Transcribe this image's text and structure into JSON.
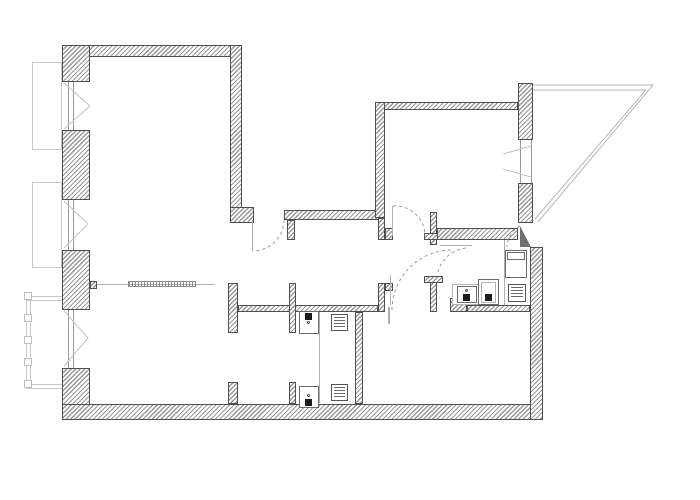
{
  "canvas": {
    "width": 700,
    "height": 500,
    "background": "#ffffff"
  },
  "drawing": {
    "type": "architectural-floor-plan",
    "colors": {
      "wall_outline": "#4f4f4f",
      "wall_hatch": "#989898",
      "dashed_arc": "#999999",
      "thin_line": "#b0b0b0",
      "fixture_line": "#6a6a6a",
      "dark_fill": "#1b1b1b",
      "exterior_line": "#c9c9c9",
      "symbol_line": "#c4c4c4",
      "balcony_line": "#b8b8b8",
      "door_leaf_fill": "#6f6f6f"
    }
  },
  "walls": [
    {
      "name": "top-wall",
      "x": 62,
      "y": 45,
      "w": 178,
      "h": 12
    },
    {
      "name": "left-pier-1",
      "x": 62,
      "y": 45,
      "w": 28,
      "h": 37
    },
    {
      "name": "left-pier-2",
      "x": 62,
      "y": 130,
      "w": 28,
      "h": 70
    },
    {
      "name": "left-pier-3",
      "x": 62,
      "y": 250,
      "w": 28,
      "h": 60
    },
    {
      "name": "left-pier-3-tab",
      "x": 90,
      "y": 281,
      "w": 7,
      "h": 8
    },
    {
      "name": "bottom-left-corner",
      "x": 62,
      "y": 368,
      "w": 28,
      "h": 52
    },
    {
      "name": "bottom-wall",
      "x": 62,
      "y": 404,
      "w": 481,
      "h": 16
    },
    {
      "name": "room1-right-wall",
      "x": 230,
      "y": 45,
      "w": 12,
      "h": 164
    },
    {
      "name": "room1-right-foot",
      "x": 230,
      "y": 207,
      "w": 24,
      "h": 16
    },
    {
      "name": "hall-top-wall",
      "x": 284,
      "y": 210,
      "w": 101,
      "h": 10
    },
    {
      "name": "hall-top-stub",
      "x": 287,
      "y": 220,
      "w": 8,
      "h": 20
    },
    {
      "name": "bedroom-top-wall",
      "x": 375,
      "y": 102,
      "w": 143,
      "h": 8
    },
    {
      "name": "bedroom-left-wall",
      "x": 375,
      "y": 102,
      "w": 10,
      "h": 116
    },
    {
      "name": "bedroom-left-wall-lower",
      "x": 378,
      "y": 218,
      "w": 7,
      "h": 22
    },
    {
      "name": "bedroom-door-jamb",
      "x": 385,
      "y": 228,
      "w": 8,
      "h": 12
    },
    {
      "name": "vestibule-stub",
      "x": 430,
      "y": 212,
      "w": 7,
      "h": 33
    },
    {
      "name": "vestibule-tab",
      "x": 424,
      "y": 233,
      "w": 34,
      "h": 7
    },
    {
      "name": "bedroom-bottom-wall",
      "x": 437,
      "y": 228,
      "w": 81,
      "h": 12
    },
    {
      "name": "right-pier-1",
      "x": 518,
      "y": 83,
      "w": 15,
      "h": 57
    },
    {
      "name": "right-pier-2",
      "x": 518,
      "y": 183,
      "w": 15,
      "h": 40
    },
    {
      "name": "right-wall",
      "x": 530,
      "y": 247,
      "w": 13,
      "h": 173
    },
    {
      "name": "kitchen-left-wall",
      "x": 430,
      "y": 276,
      "w": 7,
      "h": 36
    },
    {
      "name": "kitchen-left-tab",
      "x": 424,
      "y": 276,
      "w": 19,
      "h": 7
    },
    {
      "name": "hall-bottom-wall",
      "x": 238,
      "y": 305,
      "w": 140,
      "h": 7
    },
    {
      "name": "mid-stub",
      "x": 378,
      "y": 283,
      "w": 7,
      "h": 29
    },
    {
      "name": "mid-stub-foot",
      "x": 385,
      "y": 283,
      "w": 8,
      "h": 8
    },
    {
      "name": "closet-wall-upper",
      "x": 228,
      "y": 283,
      "w": 10,
      "h": 50
    },
    {
      "name": "bath-wall-upper",
      "x": 289,
      "y": 283,
      "w": 7,
      "h": 50
    },
    {
      "name": "closet-wall-lower",
      "x": 228,
      "y": 382,
      "w": 10,
      "h": 22
    },
    {
      "name": "bath-wall-lower",
      "x": 289,
      "y": 382,
      "w": 7,
      "h": 22
    },
    {
      "name": "bath-right-wall",
      "x": 355,
      "y": 312,
      "w": 8,
      "h": 92
    },
    {
      "name": "kitchen-corner",
      "x": 450,
      "y": 298,
      "w": 17,
      "h": 14
    },
    {
      "name": "kitchen-bottom-wall",
      "x": 467,
      "y": 305,
      "w": 63,
      "h": 7
    }
  ],
  "windows": [
    {
      "name": "window-left-1",
      "x": 68,
      "y": 82,
      "w": 6,
      "h": 48
    },
    {
      "name": "window-left-2",
      "x": 68,
      "y": 200,
      "w": 6,
      "h": 50
    },
    {
      "name": "window-left-3",
      "x": 68,
      "y": 310,
      "w": 6,
      "h": 58
    },
    {
      "name": "window-bedroom",
      "x": 520,
      "y": 140,
      "w": 12,
      "h": 43
    }
  ],
  "window_symbols": [
    {
      "name": "casement-swing-left-1",
      "points": "64,83 90,106 64,129"
    },
    {
      "name": "casement-swing-left-2",
      "points": "64,201 88,224 64,248"
    },
    {
      "name": "casement-swing-left-3",
      "points": "64,311 88,338 64,366"
    },
    {
      "name": "casement-swing-bedroom-top",
      "points": "531,146 503,154"
    },
    {
      "name": "casement-swing-bedroom-bottom",
      "points": "531,177 503,169"
    }
  ],
  "door_arcs": [
    {
      "name": "living-door-arc",
      "d": "M 284 220 A 31 31 0 0 1 253 251"
    },
    {
      "name": "bedroom-door-arc",
      "d": "M 393 206 A 30 30 0 0 1 425 236"
    },
    {
      "name": "room2-door-arc",
      "d": "M 392 310 A 60 60 0 0 1 452 250"
    },
    {
      "name": "kitchen-door-arc",
      "d": "M 438 272 A 32 32 0 0 1 468 248"
    },
    {
      "name": "entrance-door-arc",
      "d": "M 520 226 A 24 24 0 0 0 507 247"
    }
  ],
  "door_leaves": [
    {
      "name": "living-door-leaf",
      "x": 252,
      "y": 220,
      "w": 1,
      "h": 31
    },
    {
      "name": "bedroom-door-leaf",
      "x": 392,
      "y": 206,
      "w": 1,
      "h": 30
    },
    {
      "name": "room2-door-leaf",
      "x": 388,
      "y": 307,
      "w": 2,
      "h": 17
    }
  ],
  "entrance_door": {
    "name": "entrance-door-leaf",
    "triangle_points": "520,226 531,247 520,247"
  },
  "balcony": {
    "name": "triangular-balcony",
    "outer_points": "533,85 653,85 538,222",
    "inner_points": "533,90 646,90 535,219"
  },
  "exterior_left": {
    "boxes": [
      {
        "name": "ext-window-box-1",
        "x": 32,
        "y": 62,
        "w": 30,
        "h": 88
      },
      {
        "name": "ext-window-box-2",
        "x": 32,
        "y": 182,
        "w": 30,
        "h": 86
      }
    ],
    "bay_lines": [
      {
        "x": 26,
        "y": 296,
        "w": 1,
        "h": 92
      },
      {
        "x": 30,
        "y": 296,
        "w": 1,
        "h": 92
      },
      {
        "x": 26,
        "y": 296,
        "w": 36,
        "h": 1
      },
      {
        "x": 26,
        "y": 300,
        "w": 36,
        "h": 1
      },
      {
        "x": 26,
        "y": 384,
        "w": 36,
        "h": 1
      },
      {
        "x": 26,
        "y": 388,
        "w": 36,
        "h": 1
      }
    ],
    "bay_squares": [
      {
        "x": 24,
        "y": 292,
        "w": 8,
        "h": 8
      },
      {
        "x": 24,
        "y": 314,
        "w": 8,
        "h": 8
      },
      {
        "x": 24,
        "y": 336,
        "w": 8,
        "h": 8
      },
      {
        "x": 24,
        "y": 358,
        "w": 8,
        "h": 8
      },
      {
        "x": 24,
        "y": 380,
        "w": 8,
        "h": 8
      }
    ]
  },
  "fixtures": {
    "rects": [
      {
        "name": "kitchen-tall-cabinet",
        "x": 505,
        "y": 250,
        "w": 22,
        "h": 28,
        "light": false
      },
      {
        "name": "kitchen-cabinet-shelf",
        "x": 507,
        "y": 252,
        "w": 18,
        "h": 8,
        "light": false
      },
      {
        "name": "kitchen-sink-counter",
        "x": 452,
        "y": 284,
        "w": 29,
        "h": 21,
        "light": true
      },
      {
        "name": "kitchen-sink",
        "x": 457,
        "y": 286,
        "w": 20,
        "h": 17,
        "light": false
      },
      {
        "name": "kitchen-fixture",
        "x": 478,
        "y": 279,
        "w": 21,
        "h": 26,
        "light": false
      },
      {
        "name": "kitchen-fixture-inner",
        "x": 481,
        "y": 282,
        "w": 15,
        "h": 21,
        "light": true
      },
      {
        "name": "bath-sink-1",
        "x": 299,
        "y": 311,
        "w": 20,
        "h": 23,
        "light": false
      },
      {
        "name": "bath-sink-2",
        "x": 299,
        "y": 386,
        "w": 20,
        "h": 22,
        "light": false
      }
    ],
    "grates": [
      {
        "name": "stove-grate",
        "x": 508,
        "y": 284,
        "w": 18,
        "h": 18
      },
      {
        "name": "floor-grate-1",
        "x": 331,
        "y": 314,
        "w": 17,
        "h": 17
      },
      {
        "name": "floor-grate-2",
        "x": 331,
        "y": 384,
        "w": 17,
        "h": 17
      }
    ],
    "dark_squares": [
      {
        "name": "kitchen-sink-tap",
        "x": 463,
        "y": 294,
        "w": 7,
        "h": 7
      },
      {
        "name": "kitchen-fixture-tap",
        "x": 485,
        "y": 294,
        "w": 7,
        "h": 7
      },
      {
        "name": "bath-sink-1-tap",
        "x": 305,
        "y": 313,
        "w": 7,
        "h": 7
      },
      {
        "name": "bath-sink-2-tap",
        "x": 305,
        "y": 399,
        "w": 7,
        "h": 7
      }
    ],
    "dots": [
      {
        "name": "kitchen-sink-drain",
        "x": 465,
        "y": 289,
        "w": 3,
        "h": 3
      },
      {
        "name": "bath-sink-1-drain",
        "x": 307,
        "y": 321,
        "w": 3,
        "h": 3
      },
      {
        "name": "bath-sink-2-drain",
        "x": 307,
        "y": 394,
        "w": 3,
        "h": 3
      }
    ],
    "thin_lines": [
      {
        "name": "kitchen-divider-line",
        "x": 504,
        "y": 240,
        "w": 1,
        "h": 65
      },
      {
        "name": "bath-divider-line",
        "x": 319,
        "y": 312,
        "w": 1,
        "h": 91
      },
      {
        "name": "wardrobe-line",
        "x": 97,
        "y": 284,
        "w": 118,
        "h": 1
      },
      {
        "name": "corridor-line",
        "x": 390,
        "y": 275,
        "w": 1,
        "h": 30
      },
      {
        "name": "vestibule-sill-line",
        "x": 440,
        "y": 245,
        "w": 32,
        "h": 1
      }
    ],
    "wardrobe_bar": {
      "name": "wardrobe-bar",
      "x": 128,
      "y": 281,
      "w": 68,
      "h": 6
    }
  }
}
